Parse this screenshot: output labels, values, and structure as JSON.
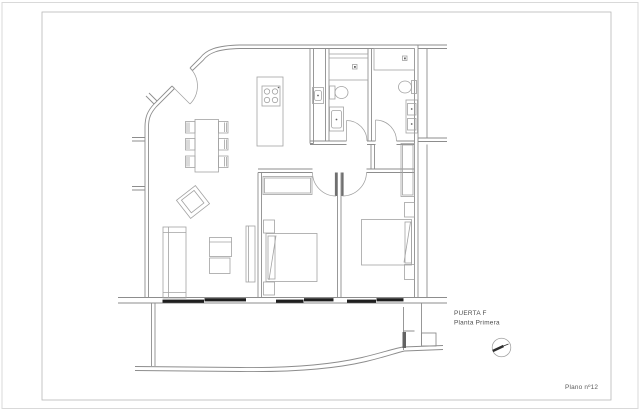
{
  "sheet": {
    "unit_label": "PUERTA F",
    "floor_label": "Planta Primera",
    "plan_number_label": "Plano nº12"
  },
  "colors": {
    "paper": "#ffffff",
    "wall": "#8d8d8d",
    "furniture": "#a2a2a2",
    "door": "#a0a0a0",
    "leaf": "#6f6f6f",
    "window": "#1f1f1f",
    "text": "#4c4c4c",
    "muted_text": "#5a5a5a",
    "frame": "#b8b8b8",
    "page_edge": "#d9d9d9"
  }
}
